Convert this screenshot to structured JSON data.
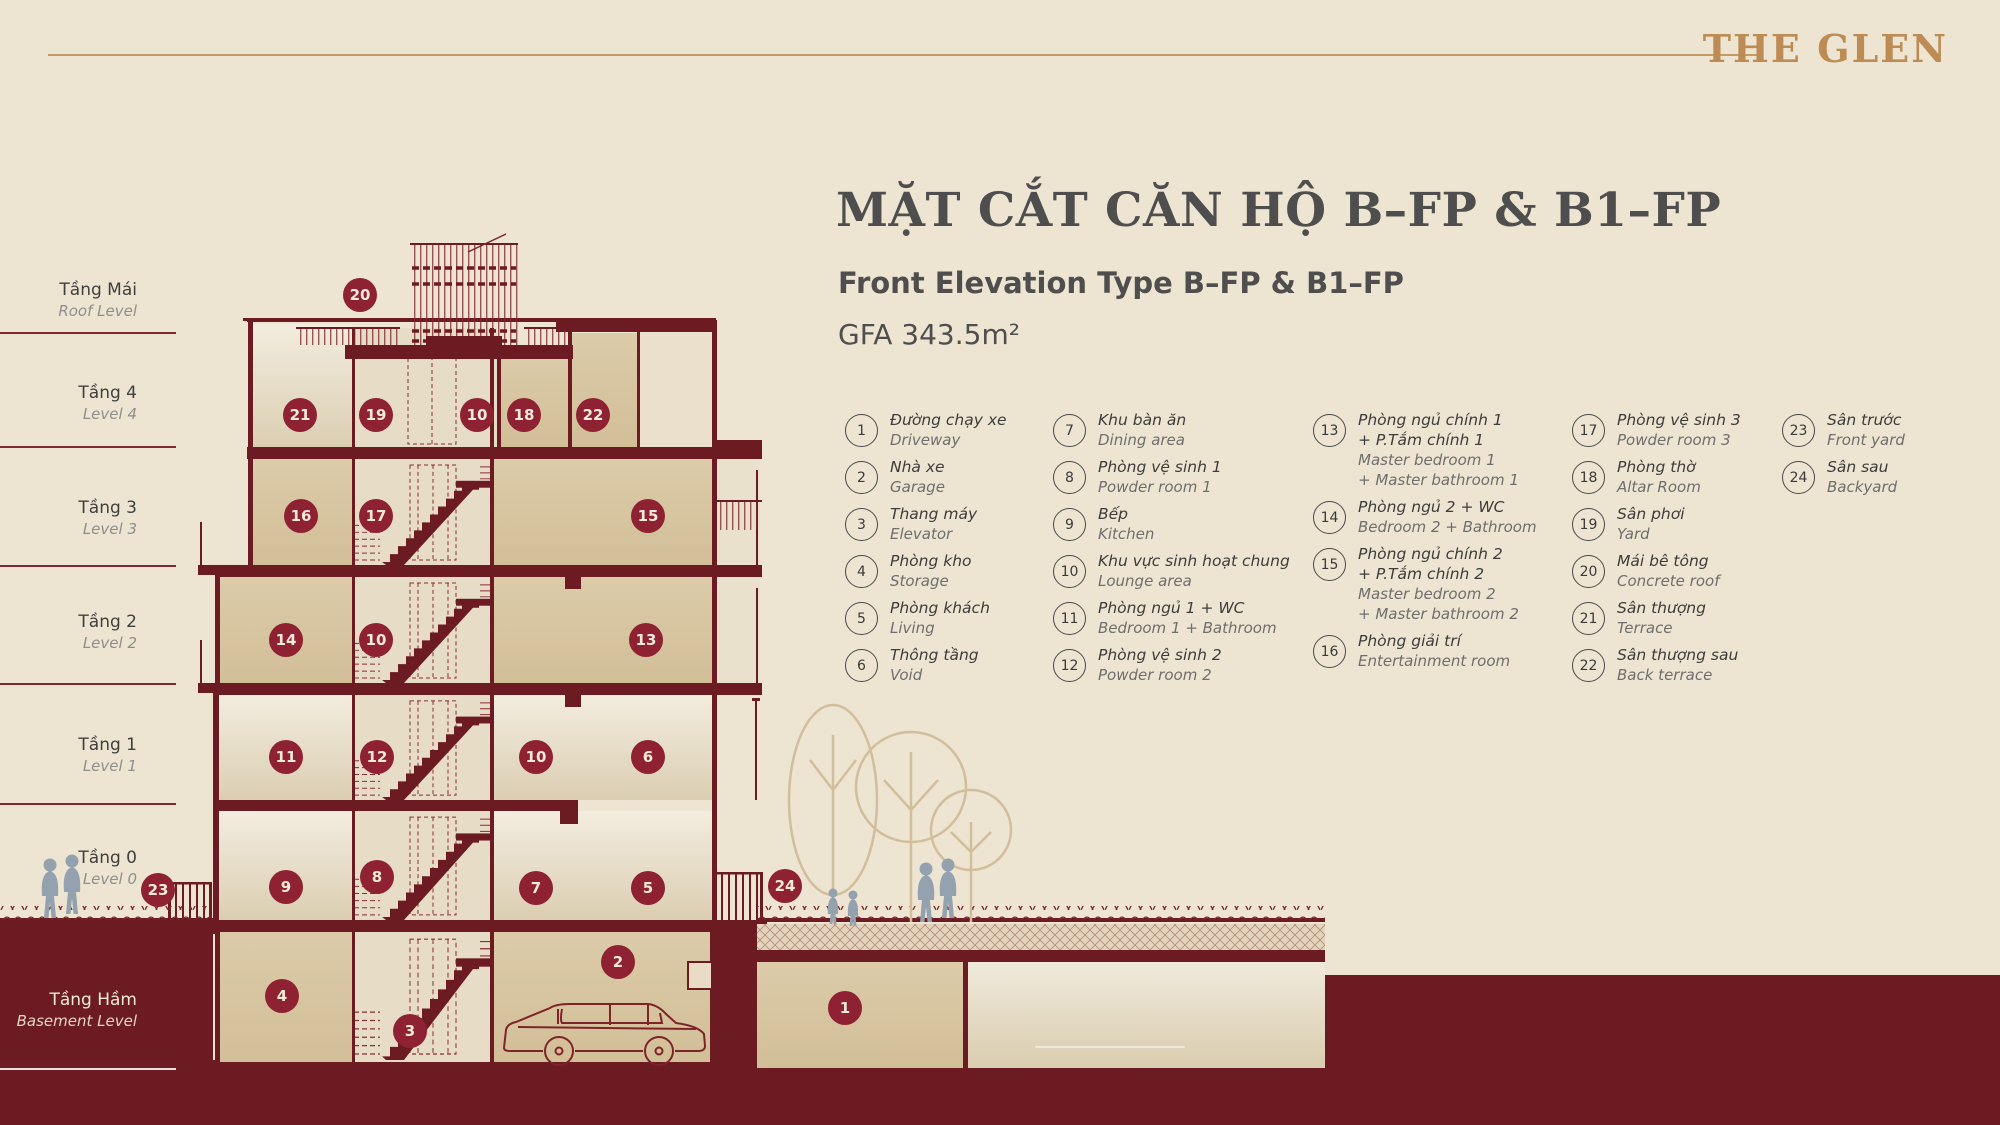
{
  "brand": "THE GLEN",
  "header": {
    "title": "MẶT CẮT CĂN HỘ B–FP & B1–FP",
    "subtitle": "Front Elevation Type B–FP & B1–FP",
    "gfa": "GFA 343.5m²"
  },
  "floor_labels": [
    {
      "vn": "Tầng Mái",
      "en": "Roof Level",
      "y": 279,
      "line_y": 332,
      "light": false
    },
    {
      "vn": "Tầng 4",
      "en": "Level 4",
      "y": 382,
      "line_y": 446,
      "light": false
    },
    {
      "vn": "Tầng 3",
      "en": "Level 3",
      "y": 497,
      "line_y": 565,
      "light": false
    },
    {
      "vn": "Tầng 2",
      "en": "Level 2",
      "y": 611,
      "line_y": 683,
      "light": false
    },
    {
      "vn": "Tầng 1",
      "en": "Level 1",
      "y": 734,
      "line_y": 803,
      "light": false
    },
    {
      "vn": "Tầng 0",
      "en": "Level 0",
      "y": 847,
      "line_y": null,
      "light": false
    },
    {
      "vn": "Tầng Hầm",
      "en": "Basement Level",
      "y": 989,
      "line_y": 1068,
      "light": true
    }
  ],
  "legend": {
    "columns": [
      {
        "x": 845,
        "items": [
          {
            "n": "1",
            "vn": "Đường chạy xe",
            "en": "Driveway"
          },
          {
            "n": "2",
            "vn": "Nhà xe",
            "en": "Garage"
          },
          {
            "n": "3",
            "vn": "Thang máy",
            "en": "Elevator"
          },
          {
            "n": "4",
            "vn": "Phòng kho",
            "en": "Storage"
          },
          {
            "n": "5",
            "vn": "Phòng khách",
            "en": "Living"
          },
          {
            "n": "6",
            "vn": "Thông tầng",
            "en": "Void"
          }
        ]
      },
      {
        "x": 1053,
        "items": [
          {
            "n": "7",
            "vn": "Khu bàn ăn",
            "en": "Dining area"
          },
          {
            "n": "8",
            "vn": "Phòng vệ sinh 1",
            "en": "Powder room 1"
          },
          {
            "n": "9",
            "vn": "Bếp",
            "en": "Kitchen"
          },
          {
            "n": "10",
            "vn": "Khu vực sinh hoạt chung",
            "en": "Lounge area"
          },
          {
            "n": "11",
            "vn": "Phòng ngủ 1 + WC",
            "en": "Bedroom 1 + Bathroom"
          },
          {
            "n": "12",
            "vn": "Phòng vệ sinh 2",
            "en": "Powder room 2"
          }
        ]
      },
      {
        "x": 1313,
        "items": [
          {
            "n": "13",
            "vn": "Phòng ngủ chính 1\n+ P.Tắm chính 1",
            "en": "Master bedroom 1\n+ Master bathroom 1"
          },
          {
            "n": "14",
            "vn": "Phòng ngủ 2 + WC",
            "en": "Bedroom 2 + Bathroom"
          },
          {
            "n": "15",
            "vn": "Phòng ngủ chính 2\n+ P.Tắm chính 2",
            "en": "Master bedroom 2\n+ Master bathroom 2"
          },
          {
            "n": "16",
            "vn": "Phòng giải trí",
            "en": "Entertainment room"
          }
        ]
      },
      {
        "x": 1572,
        "items": [
          {
            "n": "17",
            "vn": "Phòng vệ sinh 3",
            "en": "Powder room 3"
          },
          {
            "n": "18",
            "vn": "Phòng thờ",
            "en": "Altar Room"
          },
          {
            "n": "19",
            "vn": "Sân phơi",
            "en": "Yard"
          },
          {
            "n": "20",
            "vn": "Mái bê tông",
            "en": "Concrete roof"
          },
          {
            "n": "21",
            "vn": "Sân thượng",
            "en": "Terrace"
          },
          {
            "n": "22",
            "vn": "Sân thượng sau",
            "en": "Back terrace"
          }
        ]
      },
      {
        "x": 1782,
        "items": [
          {
            "n": "23",
            "vn": "Sân trước",
            "en": "Front yard"
          },
          {
            "n": "24",
            "vn": "Sân sau",
            "en": "Backyard"
          }
        ]
      }
    ]
  },
  "badges": [
    {
      "n": "20",
      "x": 360,
      "y": 295
    },
    {
      "n": "21",
      "x": 300,
      "y": 415
    },
    {
      "n": "19",
      "x": 376,
      "y": 415
    },
    {
      "n": "10",
      "x": 477,
      "y": 415
    },
    {
      "n": "18",
      "x": 524,
      "y": 415
    },
    {
      "n": "22",
      "x": 593,
      "y": 415
    },
    {
      "n": "16",
      "x": 301,
      "y": 516
    },
    {
      "n": "17",
      "x": 376,
      "y": 516
    },
    {
      "n": "15",
      "x": 648,
      "y": 516
    },
    {
      "n": "14",
      "x": 286,
      "y": 640
    },
    {
      "n": "10",
      "x": 376,
      "y": 640
    },
    {
      "n": "13",
      "x": 646,
      "y": 640
    },
    {
      "n": "11",
      "x": 286,
      "y": 757
    },
    {
      "n": "12",
      "x": 377,
      "y": 757
    },
    {
      "n": "10",
      "x": 536,
      "y": 757
    },
    {
      "n": "6",
      "x": 648,
      "y": 757
    },
    {
      "n": "9",
      "x": 286,
      "y": 887
    },
    {
      "n": "8",
      "x": 377,
      "y": 877
    },
    {
      "n": "7",
      "x": 536,
      "y": 888
    },
    {
      "n": "5",
      "x": 648,
      "y": 888
    },
    {
      "n": "23",
      "x": 158,
      "y": 890
    },
    {
      "n": "24",
      "x": 785,
      "y": 886
    },
    {
      "n": "4",
      "x": 282,
      "y": 996
    },
    {
      "n": "2",
      "x": 618,
      "y": 962
    },
    {
      "n": "3",
      "x": 410,
      "y": 1031
    },
    {
      "n": "1",
      "x": 845,
      "y": 1008
    }
  ],
  "colors": {
    "maroon": "#6D1B22",
    "badge": "#8E2132",
    "gold": "#BD8C55",
    "cream": "#EDE5D1",
    "tan": "#D9C7A4"
  }
}
